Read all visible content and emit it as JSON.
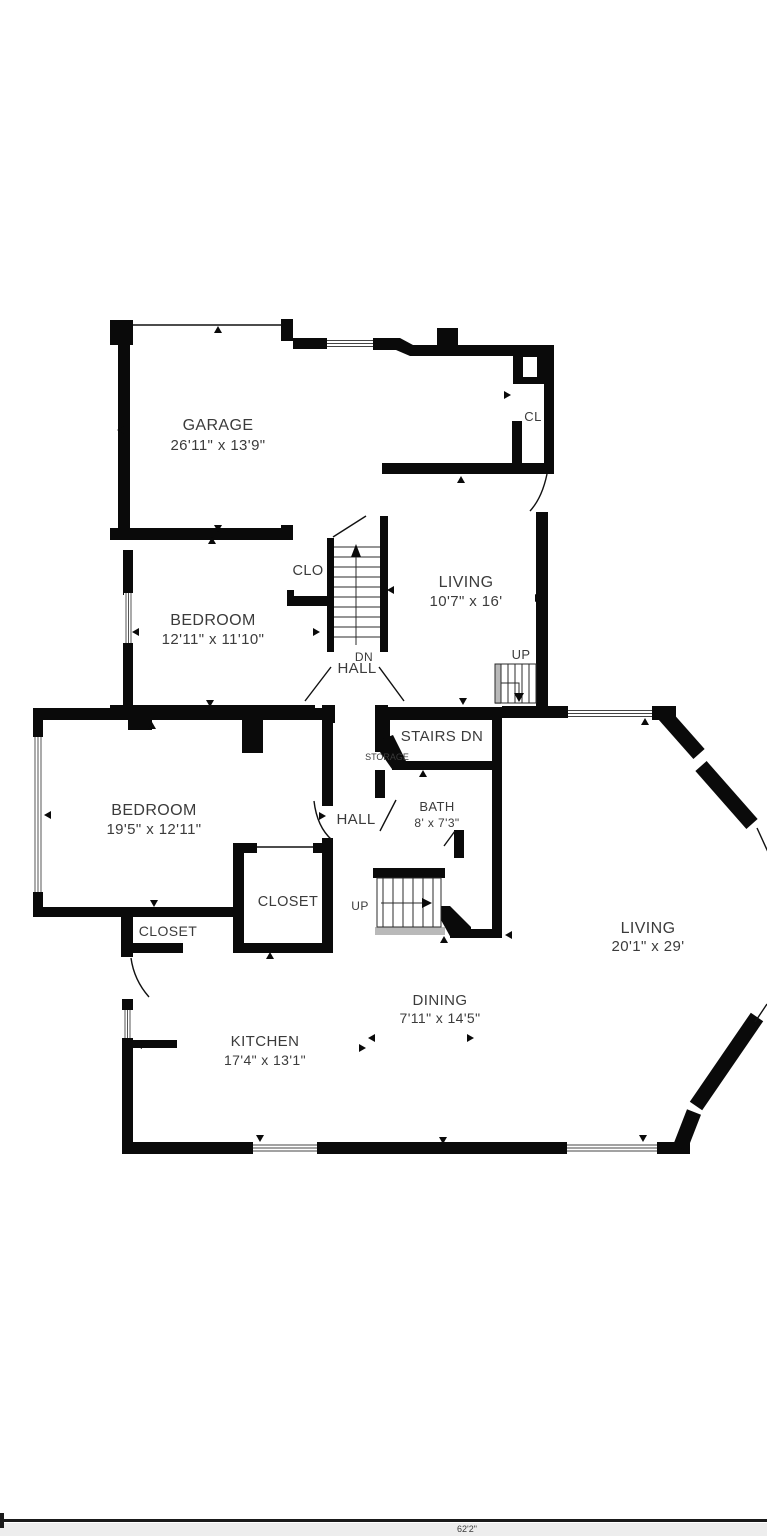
{
  "plan": {
    "rooms": {
      "garage": {
        "name": "GARAGE",
        "dims": "26'11\" x 13'9\""
      },
      "bedroom1": {
        "name": "BEDROOM",
        "dims": "12'11\" x 11'10\""
      },
      "living_upper": {
        "name": "LIVING",
        "dims": "10'7\" x 16'"
      },
      "bedroom2": {
        "name": "BEDROOM",
        "dims": "19'5\" x 12'11\""
      },
      "bath": {
        "name": "BATH",
        "dims": "8' x 7'3\""
      },
      "living_main": {
        "name": "LIVING",
        "dims": "20'1\" x 29'"
      },
      "dining": {
        "name": "DINING",
        "dims": "7'11\" x 14'5\""
      },
      "kitchen": {
        "name": "KITCHEN",
        "dims": "17'4\" x 13'1\""
      }
    },
    "labels": {
      "cl": "CL",
      "clo": "CLO",
      "dn": "DN",
      "hall_upper": "HALL",
      "hall_lower": "HALL",
      "up_entry": "UP",
      "up_lower": "UP",
      "stairs_dn": "STAIRS DN",
      "storage": "STORAGE",
      "closet_small": "CLOSET",
      "closet_wide": "CLOSET"
    },
    "scale_label": "62'2\"",
    "colors": {
      "wall": "#0a0a0a",
      "text": "#3b3b3b",
      "stair_gray": "#b9b9b9",
      "background": "#ffffff"
    }
  }
}
